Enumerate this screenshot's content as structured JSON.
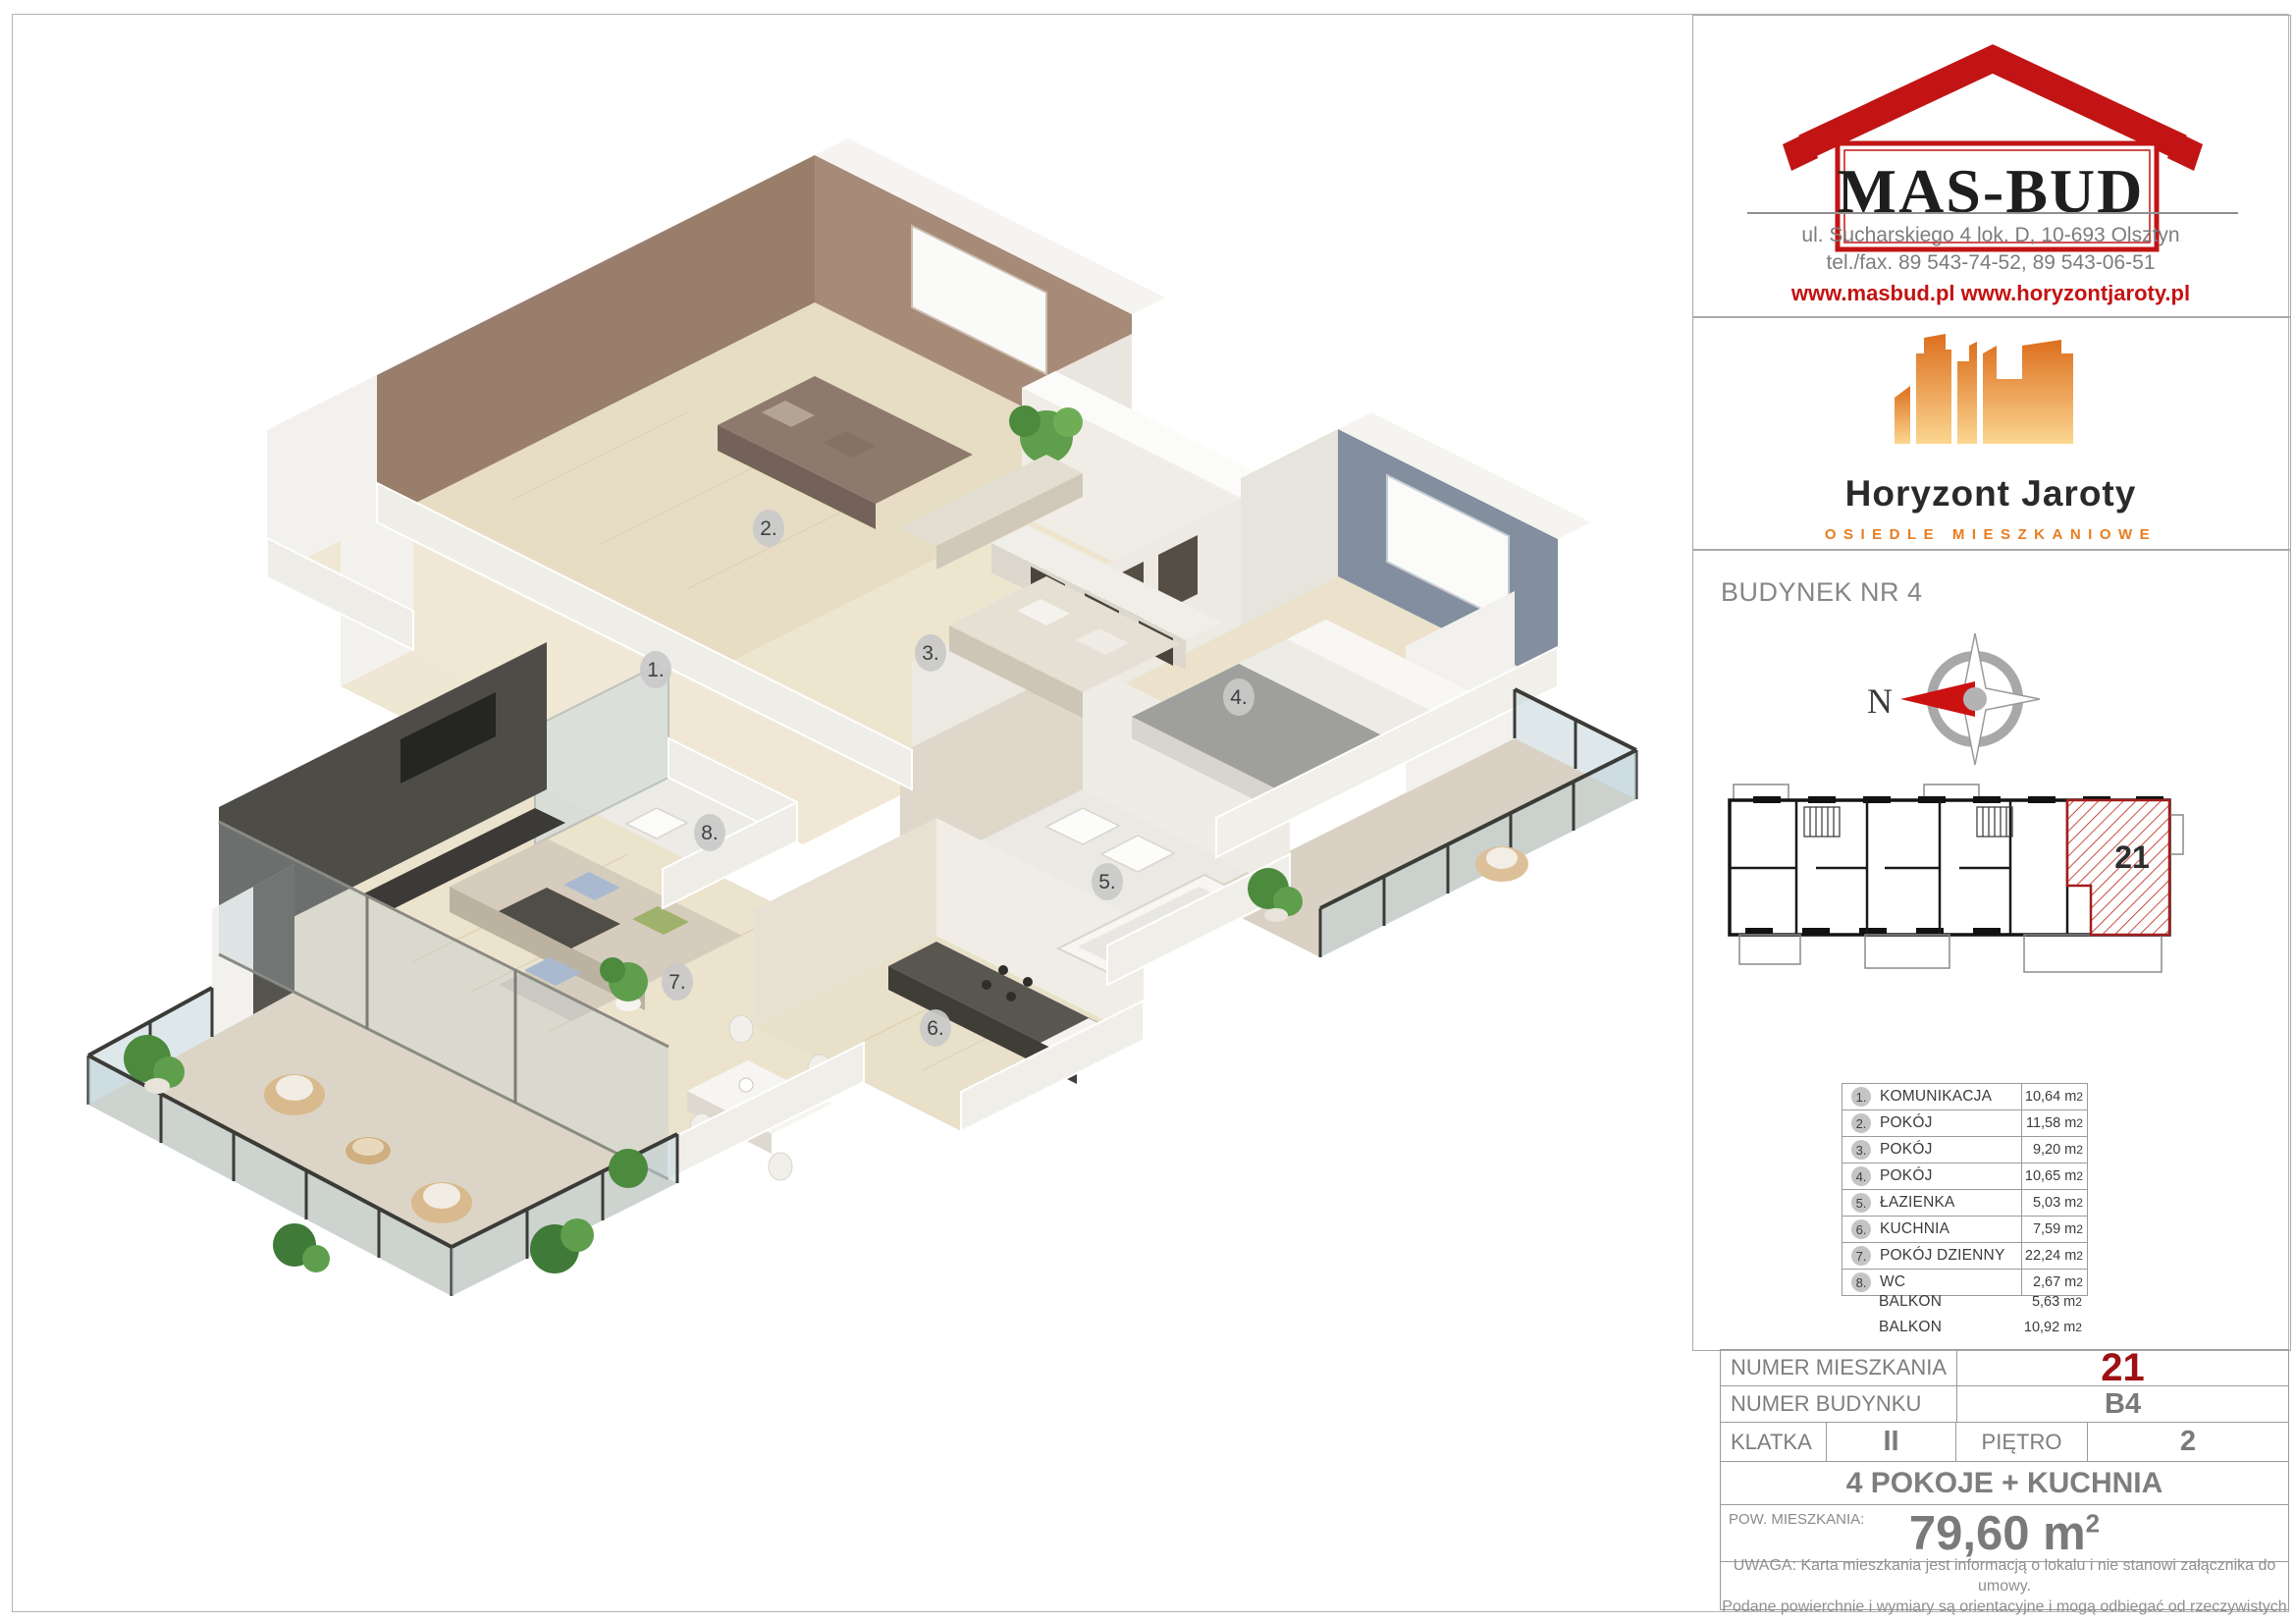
{
  "company": {
    "logo_text": "MAS-BUD",
    "address": "ul. Sucharskiego 4 lok. D, 10-693 Olsztyn",
    "phone": "tel./fax. 89 543-74-52, 89 543-06-51",
    "websites": "www.masbud.pl  www.horyzontjaroty.pl"
  },
  "estate": {
    "name": "Horyzont Jaroty",
    "subtitle": "OSIEDLE MIESZKANIOWE"
  },
  "building_header": "BUDYNEK NR 4",
  "compass": {
    "north_label": "N"
  },
  "mini_plan": {
    "apartment_label": "21"
  },
  "units": {
    "m": "m",
    "sup": "2"
  },
  "rooms": [
    {
      "num": "1.",
      "name": "KOMUNIKACJA",
      "area": "10,64"
    },
    {
      "num": "2.",
      "name": "POKÓJ",
      "area": "11,58"
    },
    {
      "num": "3.",
      "name": "POKÓJ",
      "area": "9,20"
    },
    {
      "num": "4.",
      "name": "POKÓJ",
      "area": "10,65"
    },
    {
      "num": "5.",
      "name": "ŁAZIENKA",
      "area": "5,03"
    },
    {
      "num": "6.",
      "name": "KUCHNIA",
      "area": "7,59"
    },
    {
      "num": "7.",
      "name": "POKÓJ DZIENNY",
      "area": "22,24"
    },
    {
      "num": "8.",
      "name": "WC",
      "area": "2,67"
    }
  ],
  "balconies": [
    {
      "name": "BALKON",
      "area": "5,63"
    },
    {
      "name": "BALKON",
      "area": "10,92"
    }
  ],
  "details": {
    "apartment_number_label": "NUMER MIESZKANIA",
    "apartment_number": "21",
    "building_number_label": "NUMER BUDYNKU",
    "building_number": "B4",
    "staircase_label": "KLATKA",
    "staircase": "II",
    "floor_label": "PIĘTRO",
    "floor": "2",
    "layout_summary": "4 POKOJE + KUCHNIA",
    "area_label": "POW. MIESZKANIA:",
    "area_value": "79,60 m",
    "area_sup": "2"
  },
  "disclaimer": {
    "line1": "UWAGA: Karta mieszkania jest informacją o lokalu i nie stanowi załącznika do umowy.",
    "line2": "Podane powierchnie i wymiary są orientacyjne i mogą odbiegać od rzeczywistych"
  },
  "colors": {
    "brand_red": "#c21414",
    "apartment_red": "#9e1113",
    "orange": "#e87c20",
    "gray_text": "#7e7e7e",
    "wall_brown": "#9a7e6c",
    "wall_blue_gray": "#838f9e",
    "wall_dark": "#4e4c46",
    "floor_wood": "#eae1cb"
  }
}
